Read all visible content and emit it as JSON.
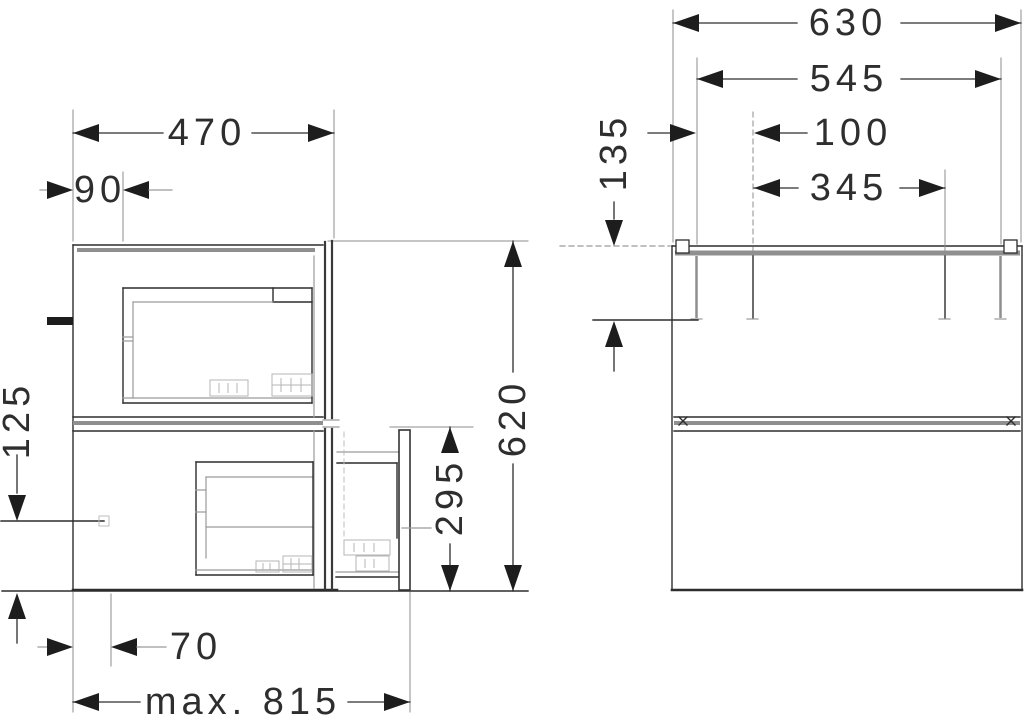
{
  "colors": {
    "background": "#ffffff",
    "main_line": "#2d2d2d",
    "secondary_line": "#8f8f8f",
    "detail_line": "#bdbdbd"
  },
  "dims": {
    "side": {
      "depth": "470",
      "front_offset": "90",
      "drain_height": "125",
      "lower_front_height": "295",
      "height": "620",
      "bottom_offset": "70",
      "max_extension": "max. 815"
    },
    "front": {
      "width": "630",
      "mount_span": "545",
      "mount_left_offset": "100",
      "mount_inner_span": "345",
      "mount_drop": "135"
    }
  }
}
